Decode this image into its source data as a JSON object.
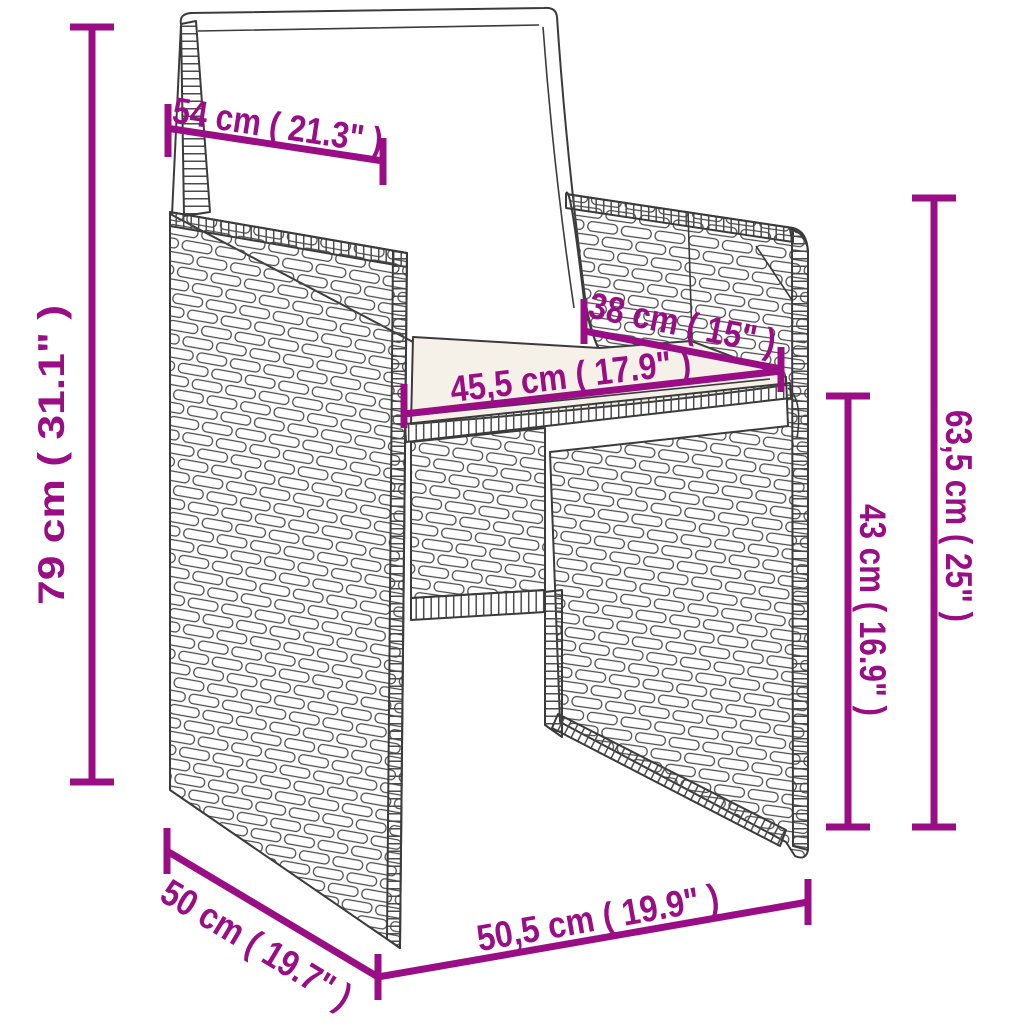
{
  "diagram": {
    "description": "Line drawing of a poly rattan garden armchair with back and seat cushions, annotated with product dimensions",
    "background_color": "#ffffff",
    "artwork_color": "#3b3b3b",
    "dimension_color": "#990d85",
    "seat_cushion_color": "#f5f1e8",
    "dimensions": [
      {
        "name": "backrest-cushion-width",
        "label": "54 cm ( 21.3\" )"
      },
      {
        "name": "overall-height",
        "label": "79 cm ( 31.1\" )"
      },
      {
        "name": "seat-depth",
        "label": "38 cm ( 15\" )"
      },
      {
        "name": "seat-width",
        "label": "45,5 cm ( 17.9\" )"
      },
      {
        "name": "armrest-height",
        "label": "63,5 cm ( 25\" )"
      },
      {
        "name": "seat-height",
        "label": "43 cm ( 16.9\" )"
      },
      {
        "name": "overall-depth",
        "label": "50 cm ( 19.7\" )"
      },
      {
        "name": "overall-width",
        "label": "50,5 cm ( 19.9\" )"
      }
    ]
  }
}
